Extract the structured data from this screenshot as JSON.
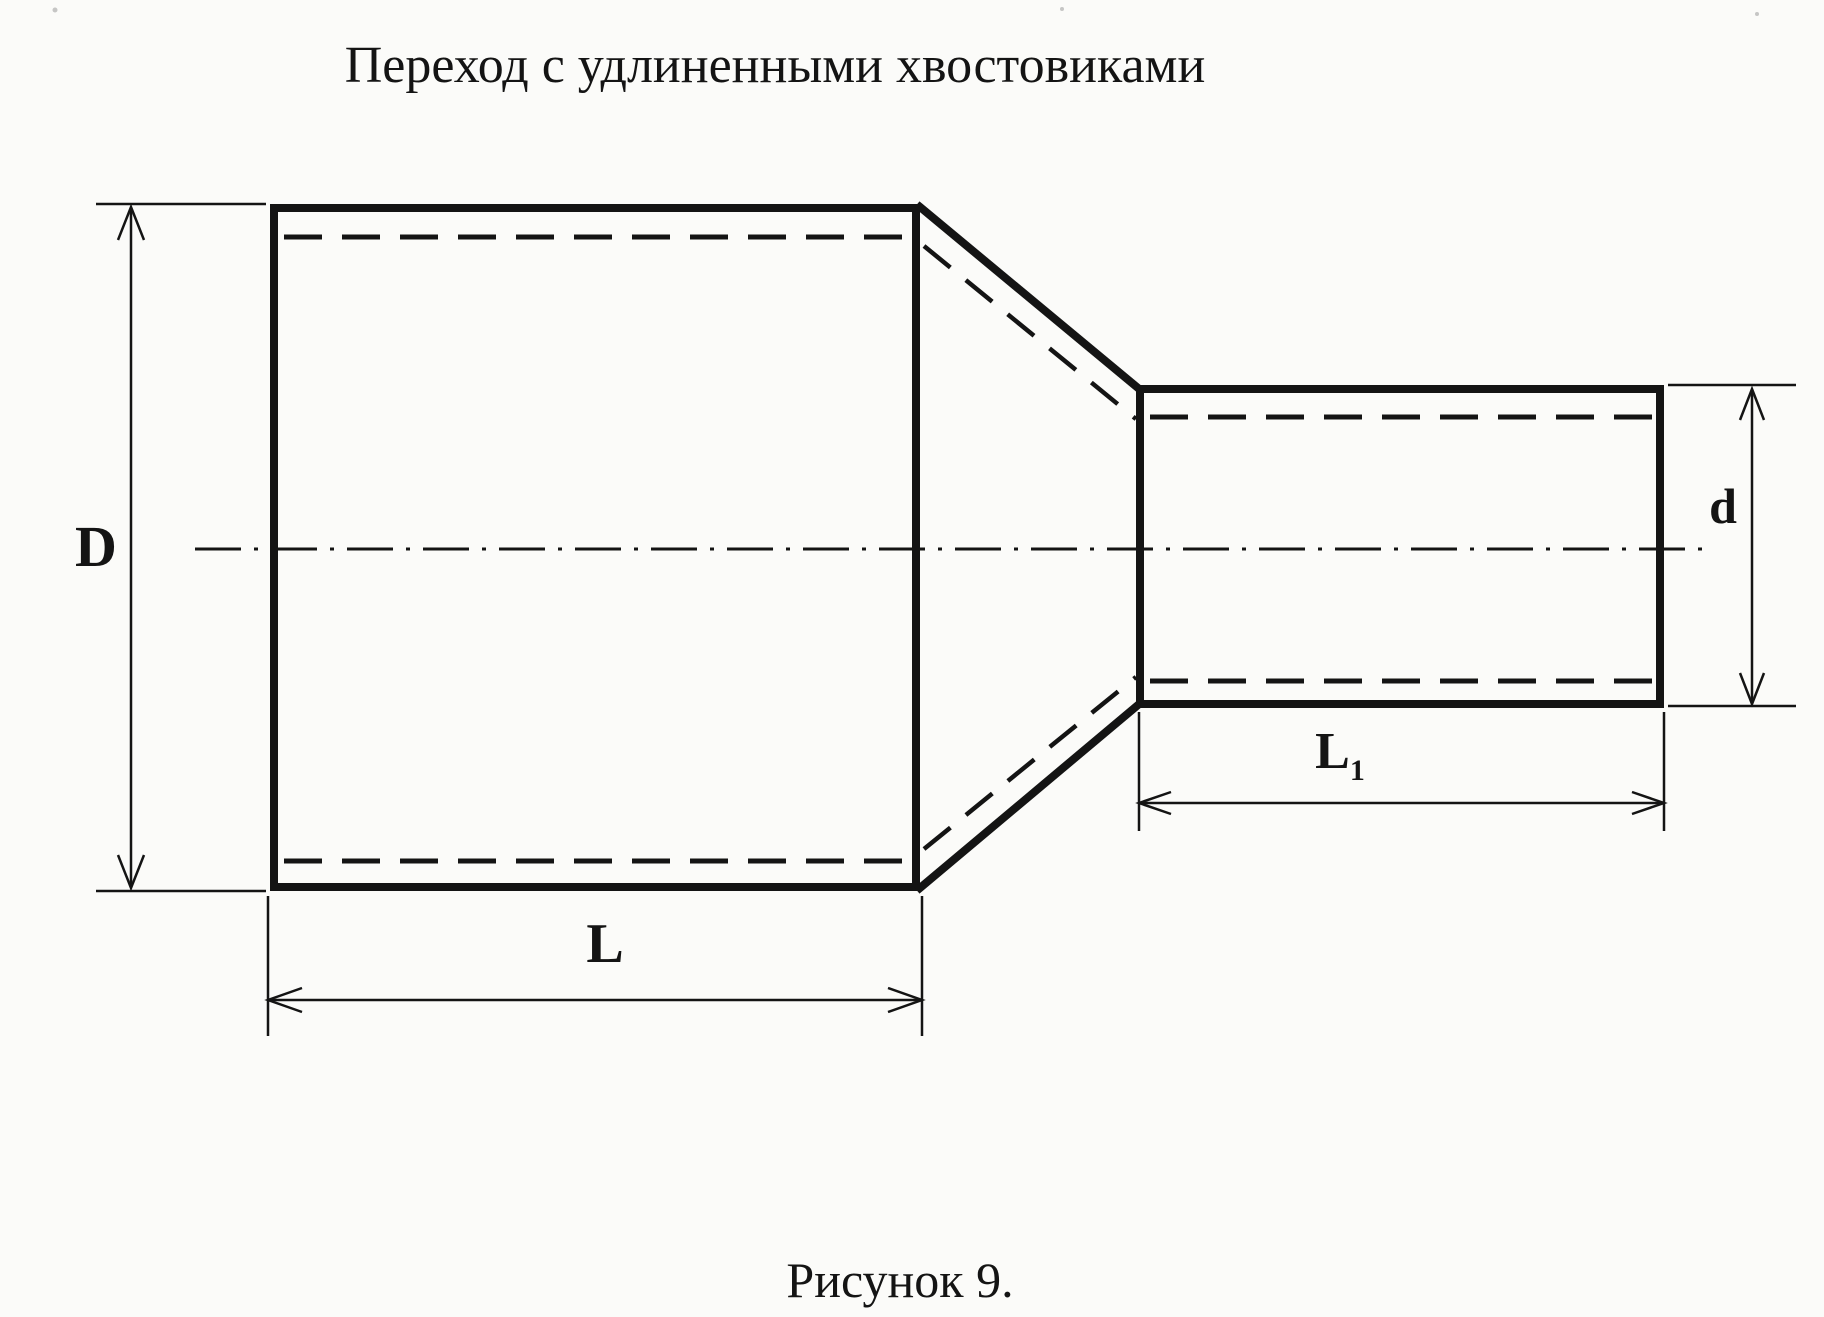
{
  "title": "Переход с удлиненными хвостовиками",
  "caption": "Рисунок 9.",
  "colors": {
    "ink": "#141414",
    "paper": "#fbfbf9"
  },
  "dimensions": {
    "outer_diameter_large": "D",
    "outer_diameter_small": "d",
    "length_large": "L",
    "length_small_base": "L",
    "length_small_sub": "1"
  }
}
